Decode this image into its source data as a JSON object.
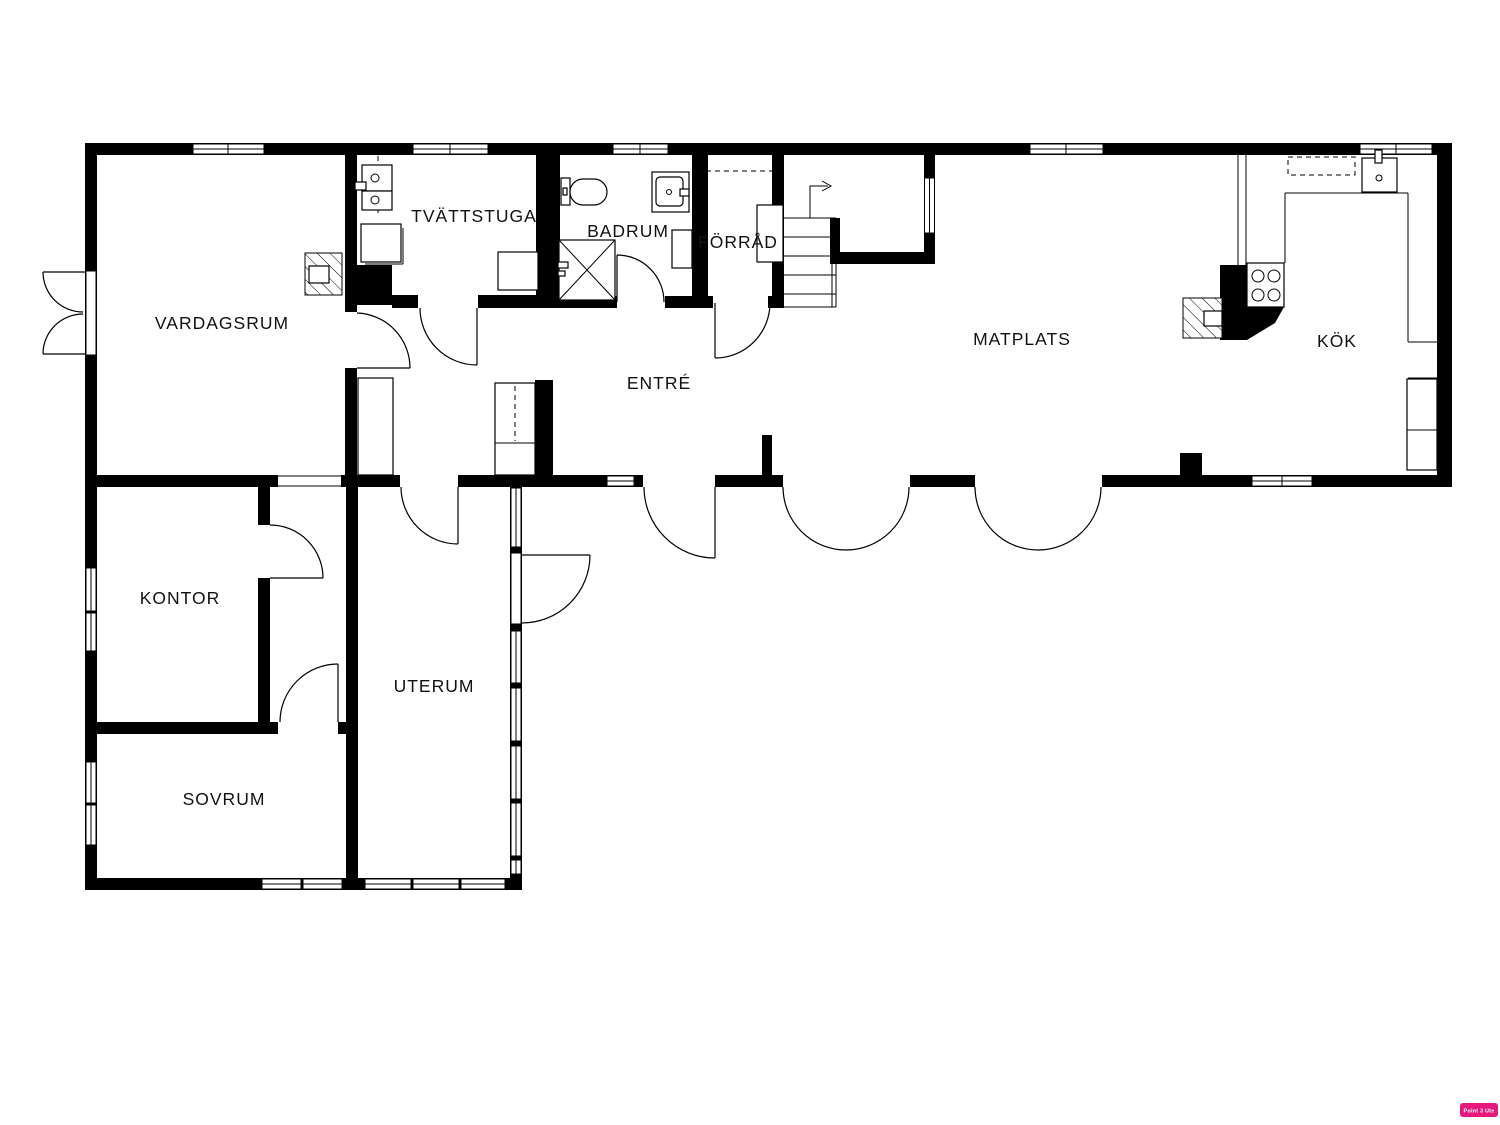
{
  "plan": {
    "rooms": [
      {
        "id": "vardagsrum",
        "label": "VARDAGSRUM"
      },
      {
        "id": "tvattstuga",
        "label": "TVÄTTSTUGA"
      },
      {
        "id": "badrum",
        "label": "BADRUM"
      },
      {
        "id": "forrad",
        "label": "FÖRRÅD"
      },
      {
        "id": "matplats",
        "label": "MATPLATS"
      },
      {
        "id": "kok",
        "label": "KÖK"
      },
      {
        "id": "entre",
        "label": "ENTRÉ"
      },
      {
        "id": "kontor",
        "label": "KONTOR"
      },
      {
        "id": "uterum",
        "label": "UTERUM"
      },
      {
        "id": "sovrum",
        "label": "SOVRUM"
      }
    ],
    "watermark": {
      "text": "Point 3 Ute",
      "color": "#e6187d"
    }
  }
}
